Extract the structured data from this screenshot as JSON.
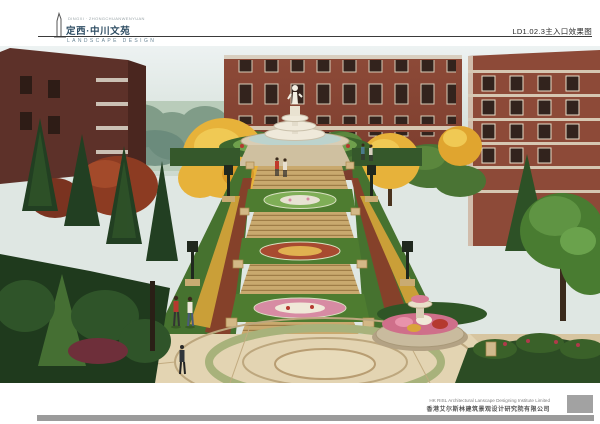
{
  "header": {
    "tagline": "DINGXI · ZHONGCHUANWENYUAN",
    "title": "定西·中川文苑",
    "subtitle": "LANDSCAPE DESIGN",
    "sheet_label": "LD1.02.3主入口效果图",
    "title_color": "#2e4d63",
    "rule_color": "#3a3a3a"
  },
  "footer": {
    "company_en": "HK RISL Architectural Lanscape Designing Institute Limited",
    "company_cn": "香港艾尔斯林建筑景观设计研究院有限公司",
    "bar_color": "#9b9b9b",
    "block_color": "#a2a2a2"
  },
  "rendering": {
    "description": "Main entrance perspective rendering: axial grand staircase with flower parterres leading up to a white tiered statue fountain, red brick residential buildings behind, golden ginkgo and green trees, circular paved plaza with round flower fountain in foreground",
    "palette": {
      "sky": "#e8eef0",
      "brick": "#8d4a38",
      "dark_brick": "#5d3129",
      "steps": "#c9a96e",
      "hedge": "#35582b",
      "ginkgo": "#e7b23a",
      "maple": "#8c3b22",
      "paving": "#d7c5a0",
      "flowers_pink": "#d78ba3",
      "flowers_red": "#b5392f"
    }
  }
}
